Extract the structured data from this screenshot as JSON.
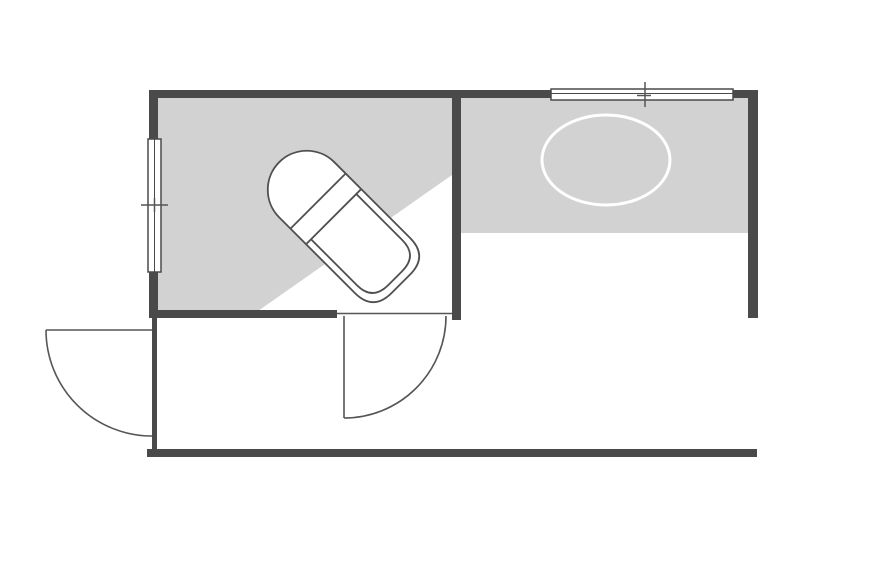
{
  "document": {
    "kind": "floor-plan",
    "description": "Architectural floor plan with bathroom (rotated bathtub), adjacent room with oval table, two door swings and two windows"
  },
  "canvas": {
    "width": 892,
    "height": 573,
    "background": "#ffffff"
  },
  "colors": {
    "wall": "#4a4a4a",
    "floor": "#d2d2d2",
    "line": "#555555",
    "fixture_stroke": "#4f4f4f",
    "white": "#ffffff"
  },
  "elements": [
    {
      "type": "rect",
      "name": "floor-left-room",
      "interactable": false,
      "x": 158,
      "y": 98,
      "w": 294,
      "h": 213,
      "fill": "#d2d2d2"
    },
    {
      "type": "polygon",
      "name": "floor-highlight-wedge",
      "interactable": false,
      "points": "258,311 452,175 452,311",
      "fill": "#ffffff"
    },
    {
      "type": "rect",
      "name": "floor-right-room",
      "interactable": false,
      "x": 461,
      "y": 98,
      "w": 287,
      "h": 135,
      "fill": "#d2d2d2"
    },
    {
      "type": "ellipse",
      "name": "oval-table-icon",
      "interactable": false,
      "cx": 606,
      "cy": 160,
      "rx": 64,
      "ry": 45,
      "fill": "none",
      "stroke": "#ffffff",
      "sw": 3
    },
    {
      "type": "group",
      "name": "bathtub-icon",
      "interactable": false,
      "transform": "translate(340,223) rotate(-45)",
      "children": [
        {
          "type": "path",
          "name": "bathtub-outer-rim",
          "interactable": false,
          "d": "M -39 -47 A 39 39 0 0 1 39 -47 L 39 60 Q 39 86 13 86 L -13 86 Q -39 86 -39 60 Z",
          "fill": "#ffffff",
          "stroke": "#4f4f4f",
          "sw": 1.8
        },
        {
          "type": "line",
          "name": "bathtub-headrest-line",
          "interactable": false,
          "x1": -39,
          "y1": -31,
          "x2": 39,
          "y2": -31,
          "stroke": "#4f4f4f",
          "sw": 1.8
        },
        {
          "type": "line",
          "name": "bathtub-basin-top-line",
          "interactable": false,
          "x1": -39,
          "y1": -9,
          "x2": 39,
          "y2": -9,
          "stroke": "#4f4f4f",
          "sw": 1.8
        },
        {
          "type": "path",
          "name": "bathtub-inner-basin",
          "interactable": false,
          "d": "M -32 -9 L -32 56 Q -32 78 -10 78 L 10 78 Q 32 78 32 56 L 32 -9",
          "fill": "none",
          "stroke": "#4f4f4f",
          "sw": 1.8
        }
      ]
    },
    {
      "type": "rect",
      "name": "wall-top-left",
      "interactable": false,
      "x": 149,
      "y": 90,
      "w": 402,
      "h": 8,
      "fill": "#4a4a4a"
    },
    {
      "type": "rect",
      "name": "wall-top-right",
      "interactable": false,
      "x": 733,
      "y": 90,
      "w": 25,
      "h": 8,
      "fill": "#4a4a4a"
    },
    {
      "type": "rect",
      "name": "wall-right",
      "interactable": false,
      "x": 748,
      "y": 90,
      "w": 10,
      "h": 228,
      "fill": "#4a4a4a"
    },
    {
      "type": "rect",
      "name": "wall-divider",
      "interactable": false,
      "x": 452,
      "y": 90,
      "w": 9,
      "h": 230,
      "fill": "#4a4a4a"
    },
    {
      "type": "rect",
      "name": "wall-left-upper",
      "interactable": false,
      "x": 149,
      "y": 90,
      "w": 9,
      "h": 49,
      "fill": "#4a4a4a"
    },
    {
      "type": "rect",
      "name": "wall-left-lower",
      "interactable": false,
      "x": 149,
      "y": 272,
      "w": 9,
      "h": 46,
      "fill": "#4a4a4a"
    },
    {
      "type": "rect",
      "name": "wall-bottom-left-room",
      "interactable": false,
      "x": 149,
      "y": 310,
      "w": 188,
      "h": 8,
      "fill": "#4a4a4a"
    },
    {
      "type": "rect",
      "name": "wall-lower-left-thin",
      "interactable": false,
      "x": 152,
      "y": 318,
      "w": 5,
      "h": 131,
      "fill": "#4a4a4a"
    },
    {
      "type": "rect",
      "name": "wall-bottom",
      "interactable": false,
      "x": 147,
      "y": 449,
      "w": 610,
      "h": 8,
      "fill": "#4a4a4a"
    },
    {
      "type": "rect",
      "name": "window-left-frame",
      "interactable": false,
      "x": 148,
      "y": 139,
      "w": 13,
      "h": 133,
      "fill": "#ffffff",
      "stroke": "#4a4a4a",
      "sw": 1.5
    },
    {
      "type": "line",
      "name": "window-left-pane-line",
      "interactable": false,
      "x1": 154.5,
      "y1": 139,
      "x2": 154.5,
      "y2": 272,
      "stroke": "#4a4a4a",
      "sw": 1
    },
    {
      "type": "line",
      "name": "window-left-tick",
      "interactable": false,
      "x1": 141,
      "y1": 205,
      "x2": 168,
      "y2": 205,
      "stroke": "#555555",
      "sw": 1.5
    },
    {
      "type": "line",
      "name": "window-left-center-dash",
      "interactable": false,
      "x1": 154.5,
      "y1": 198,
      "x2": 154.5,
      "y2": 212,
      "stroke": "#555555",
      "sw": 1.5
    },
    {
      "type": "rect",
      "name": "window-top-frame",
      "interactable": false,
      "x": 551,
      "y": 89,
      "w": 182,
      "h": 11,
      "fill": "#ffffff",
      "stroke": "#4a4a4a",
      "sw": 1.5
    },
    {
      "type": "line",
      "name": "window-top-pane-line",
      "interactable": false,
      "x1": 551,
      "y1": 93.5,
      "x2": 733,
      "y2": 93.5,
      "stroke": "#4a4a4a",
      "sw": 1
    },
    {
      "type": "line",
      "name": "window-top-tick",
      "interactable": false,
      "x1": 645,
      "y1": 82,
      "x2": 645,
      "y2": 107,
      "stroke": "#555555",
      "sw": 1.5
    },
    {
      "type": "line",
      "name": "window-top-center-dash",
      "interactable": false,
      "x1": 637,
      "y1": 95.5,
      "x2": 651,
      "y2": 95.5,
      "stroke": "#555555",
      "sw": 1.5
    },
    {
      "type": "line",
      "name": "door-left-leaf",
      "interactable": false,
      "x1": 46,
      "y1": 330,
      "x2": 152,
      "y2": 330,
      "stroke": "#555555",
      "sw": 1.6
    },
    {
      "type": "path",
      "name": "door-left-swing-arc",
      "interactable": false,
      "d": "M 46 330 A 106 106 0 0 0 152 436",
      "fill": "none",
      "stroke": "#555555",
      "sw": 1.6
    },
    {
      "type": "line",
      "name": "door-middle-threshold",
      "interactable": false,
      "x1": 337,
      "y1": 313.5,
      "x2": 452,
      "y2": 313.5,
      "stroke": "#555555",
      "sw": 1.5
    },
    {
      "type": "line",
      "name": "door-middle-leaf",
      "interactable": false,
      "x1": 344,
      "y1": 316,
      "x2": 344,
      "y2": 418,
      "stroke": "#555555",
      "sw": 1.6
    },
    {
      "type": "path",
      "name": "door-middle-swing-arc",
      "interactable": false,
      "d": "M 344 418 A 102 102 0 0 0 446 316",
      "fill": "none",
      "stroke": "#555555",
      "sw": 1.6
    }
  ]
}
